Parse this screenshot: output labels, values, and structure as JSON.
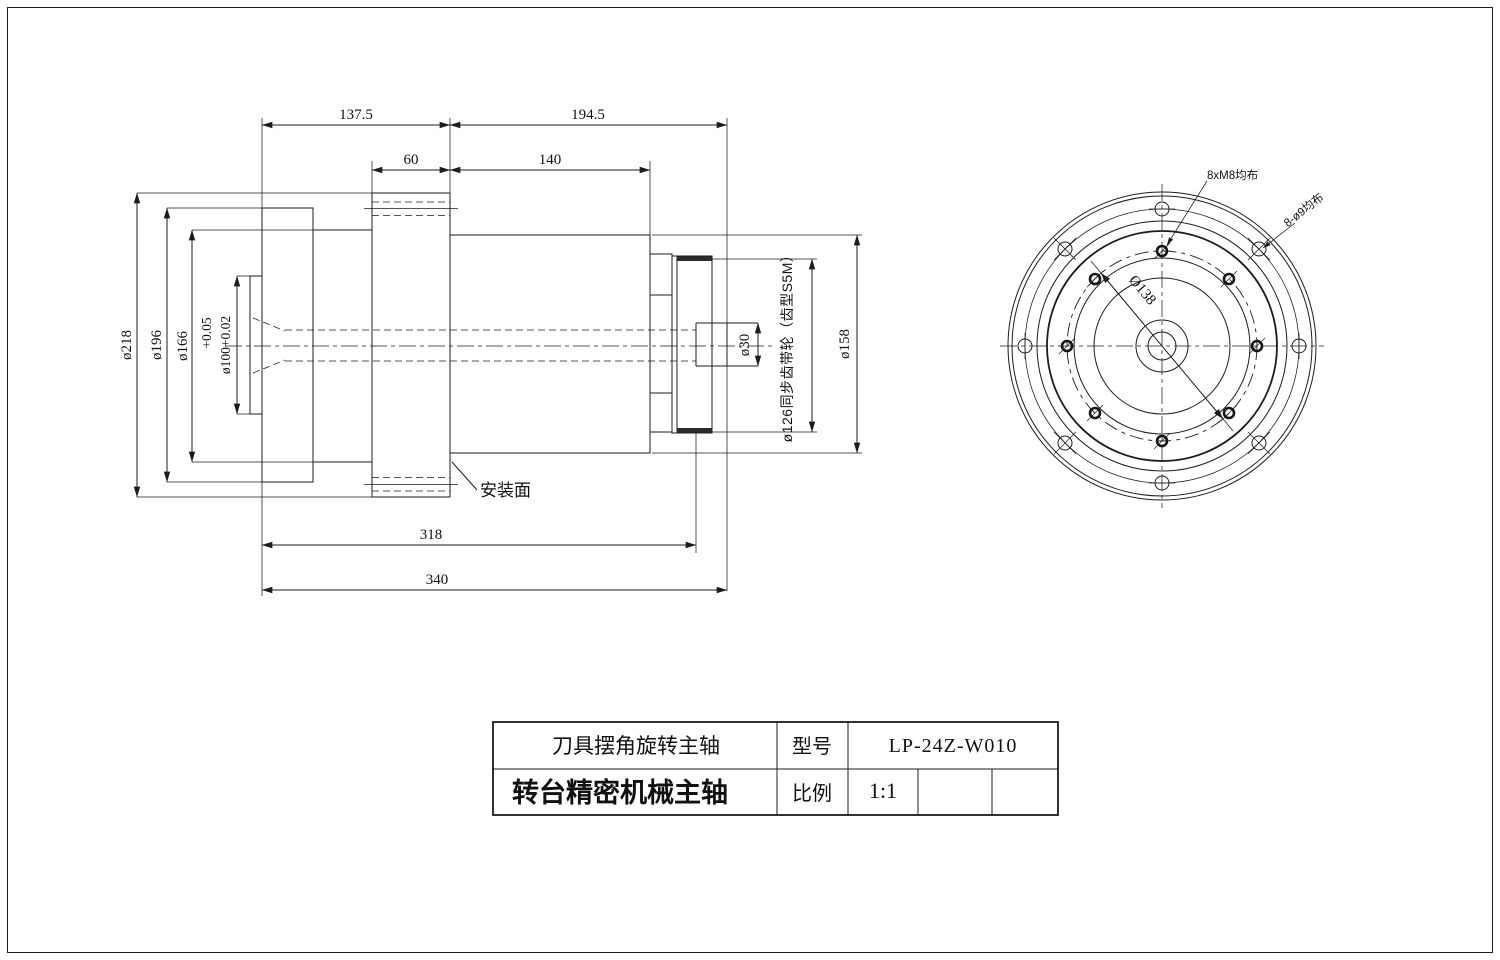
{
  "side_view": {
    "dim_137_5": "137.5",
    "dim_194_5": "194.5",
    "dim_60": "60",
    "dim_140": "140",
    "dim_318": "318",
    "dim_340": "340",
    "dia_218": "ø218",
    "dia_196": "ø196",
    "dia_166": "ø166",
    "dia_100_tol_upper": "+0.05",
    "dia_100": "ø100+0.02",
    "dia_30": "ø30",
    "dia_158": "ø158",
    "pulley_label": "ø126同步齿带轮（齿型S5M）",
    "mounting_face_label": "安装面"
  },
  "end_view": {
    "bolt_circle_dia": "Ø138",
    "m8_leader": "8xM8均布",
    "o9_leader": "8-ø9均布"
  },
  "title_block": {
    "product_name": "刀具摆角旋转主轴",
    "model_label": "型号",
    "model_value": "LP-24Z-W010",
    "series_name": "转台精密机械主轴",
    "scale_label": "比例",
    "scale_value": "1:1"
  }
}
